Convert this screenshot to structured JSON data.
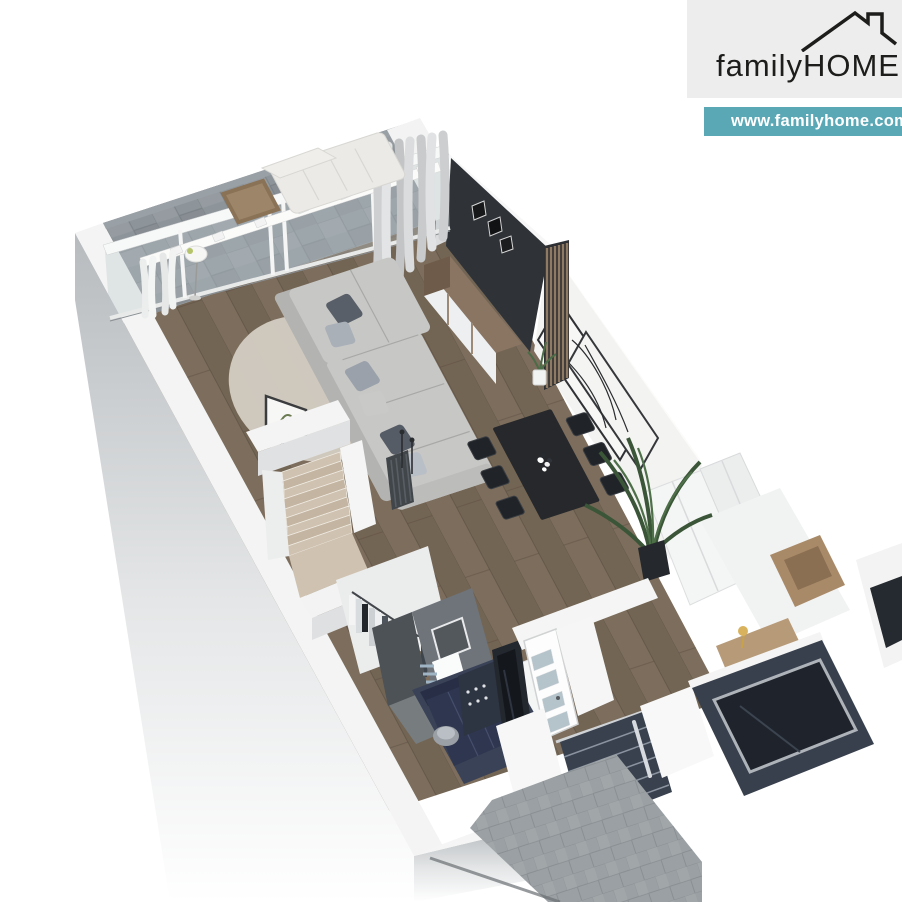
{
  "branding": {
    "family": "family",
    "home": "HOME",
    "website": "www.familyhome.com.",
    "banner_bg": "#5aa8b6",
    "panel_bg": "#ededed",
    "text_color": "#1d1d1b"
  },
  "palette": {
    "slate": "#8e959a",
    "wood_floor": "#796a59",
    "wall_white": "#f3f4f3",
    "wall_face_gray": "#b7bbbe",
    "charcoal_wall": "#2f3338",
    "accent_navy": "#39404d",
    "front_door_navy": "#39414f",
    "entry_navy": "#3a4257",
    "path_gray": "#9aa0a3",
    "stair_wood": "#cfc2b0",
    "table_black": "#26282b",
    "sofa_gray": "#c7c7c5",
    "rug": "#d4cec3",
    "glass": "#b9c7cb"
  },
  "scene": {
    "description": "3D isometric floor plan render of a single-family house ground floor",
    "rooms": [
      {
        "name": "terrace"
      },
      {
        "name": "living-room"
      },
      {
        "name": "dining-area"
      },
      {
        "name": "staircase"
      },
      {
        "name": "wardrobe"
      },
      {
        "name": "bathroom"
      },
      {
        "name": "entry-hall"
      },
      {
        "name": "front-entrance"
      },
      {
        "name": "driveway-path"
      }
    ]
  }
}
